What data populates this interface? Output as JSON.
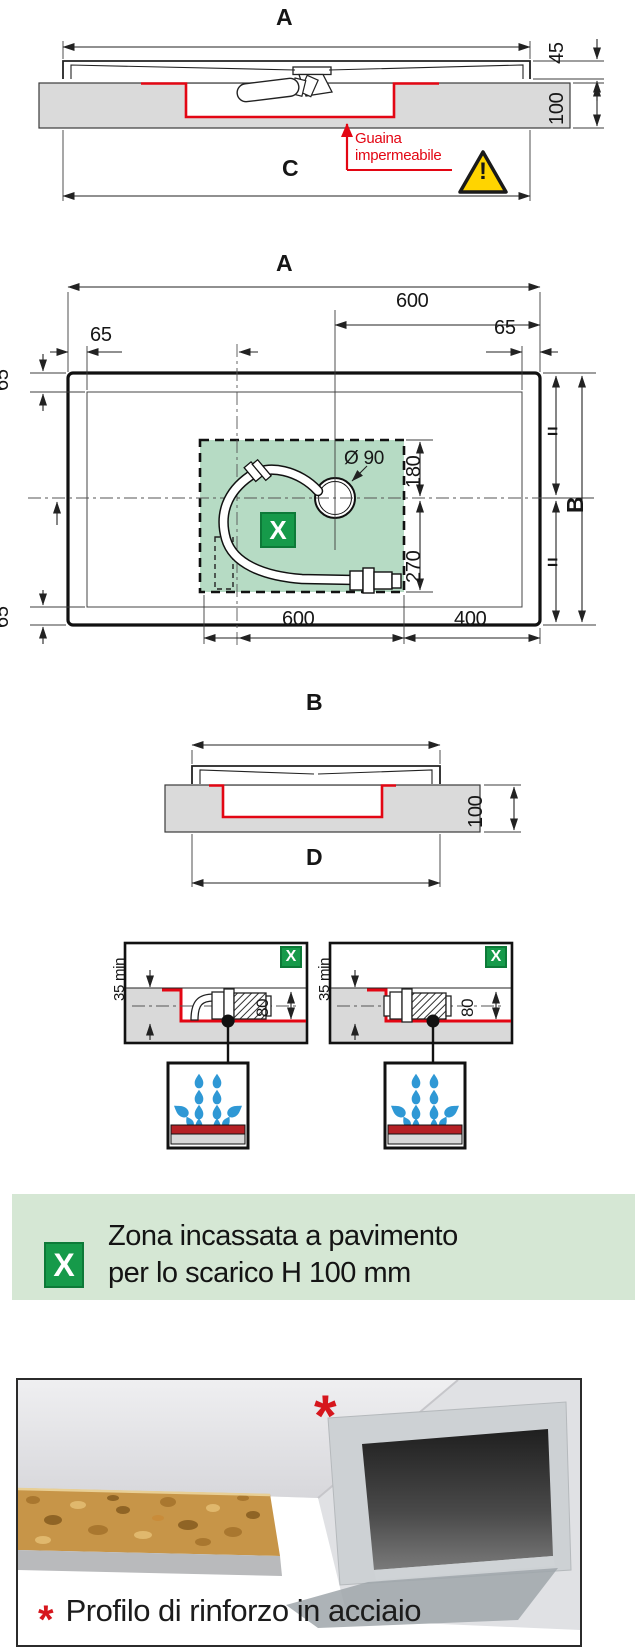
{
  "colors": {
    "membrane_red": "#e30613",
    "marker_green": "#169a4a",
    "zone_green_fill": "#b6dbc4",
    "banner_green": "#d5e7d4",
    "floor_gray": "#dadada",
    "water_blue": "#2f98d5",
    "warning_yellow": "#ffd400"
  },
  "icons": {
    "warning": "warning-triangle-icon",
    "water_drops": "water-drops-icon",
    "zone_marker": "zone-x-marker",
    "membrane_arrow": "red-up-arrow-icon",
    "asterisk": "asterisk-marker"
  },
  "side_section_a": {
    "dim_a": "A",
    "dim_45": "45",
    "dim_100": "100",
    "dim_c": "C",
    "membrane_line1": "Guaina",
    "membrane_line2": "impermeabile",
    "warning_mark": "!"
  },
  "plan_view": {
    "dim_a": "A",
    "dim_600_top": "600",
    "dim_65_top_left": "65",
    "dim_65_top_right": "65",
    "dim_65_left_upper": "65",
    "dim_65_left_lower": "65",
    "drain_diameter": "Ø 90",
    "zone_marker": "X",
    "dim_180": "180",
    "dim_270": "270",
    "equal_upper": "=",
    "equal_lower": "=",
    "dim_b": "B",
    "dim_600_bottom": "600",
    "dim_400": "400"
  },
  "side_section_b": {
    "dim_b": "B",
    "dim_100": "100",
    "dim_d": "D"
  },
  "drain_details": {
    "left": {
      "marker": "X",
      "dim_min": "35 min",
      "dim_height": "80"
    },
    "right": {
      "marker": "X",
      "dim_min": "35 min",
      "dim_height": "80"
    }
  },
  "legend": {
    "marker": "X",
    "line1": "Zona incassata a pavimento",
    "line2": "per lo scarico H 100 mm"
  },
  "photo": {
    "marker": "*",
    "caption": "Profilo di rinforzo in acciaio"
  }
}
